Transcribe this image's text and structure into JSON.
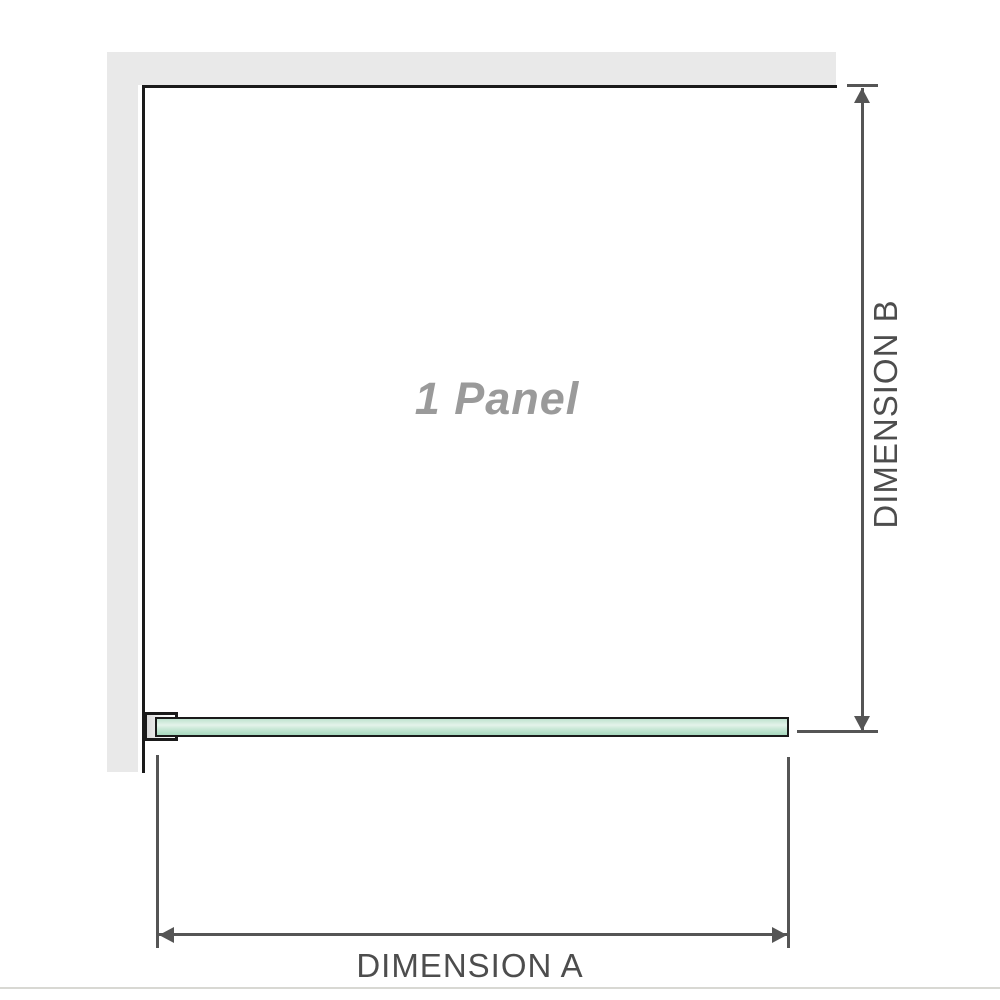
{
  "diagram": {
    "title": "1 Panel",
    "dimension_a_label": "DIMENSION A",
    "dimension_b_label": "DIMENSION B",
    "icons": {
      "dimension_b_top": "arrow-up-icon",
      "dimension_b_bottom": "arrow-down-icon",
      "dimension_a_left": "arrow-left-icon",
      "dimension_a_right": "arrow-right-icon"
    },
    "colors": {
      "background": "#ffffff",
      "wall": "#e9e9e9",
      "outline": "#1a1a1a",
      "bracket_fill": "#d9d9d9",
      "glass_top": "#bfe3cf",
      "glass_light": "#e4f3ea",
      "glass_mid": "#c9e8d7",
      "glass_bottom": "#a7d9be",
      "dim_line": "#555555",
      "label_text": "#4d4d4d",
      "title_text": "#9a9a9a",
      "separator": "#d8d8d3"
    }
  }
}
